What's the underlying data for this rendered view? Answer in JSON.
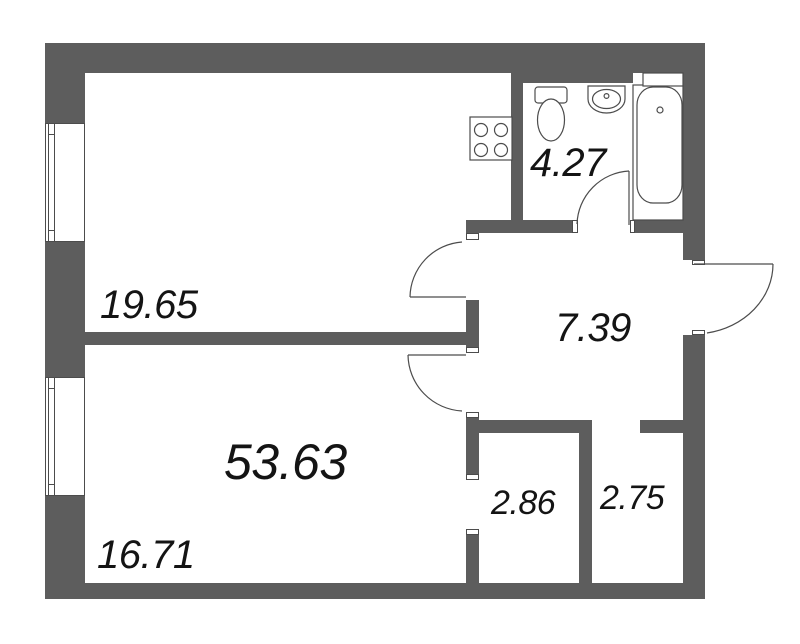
{
  "floorplan": {
    "total_area_label": "53.63",
    "rooms": [
      {
        "name": "room-top-left",
        "area_label": "19.65"
      },
      {
        "name": "room-bottom-left",
        "area_label": "16.71"
      },
      {
        "name": "bathroom",
        "area_label": "4.27"
      },
      {
        "name": "hallway",
        "area_label": "7.39"
      },
      {
        "name": "closet-left",
        "area_label": "2.86"
      },
      {
        "name": "closet-right",
        "area_label": "2.75"
      }
    ],
    "fixtures": [
      "stove",
      "toilet",
      "sink",
      "bathtub"
    ],
    "colors": {
      "wall": "#5d5d5d",
      "line": "#4c4c4c",
      "text": "#141414",
      "background": "#ffffff"
    }
  }
}
